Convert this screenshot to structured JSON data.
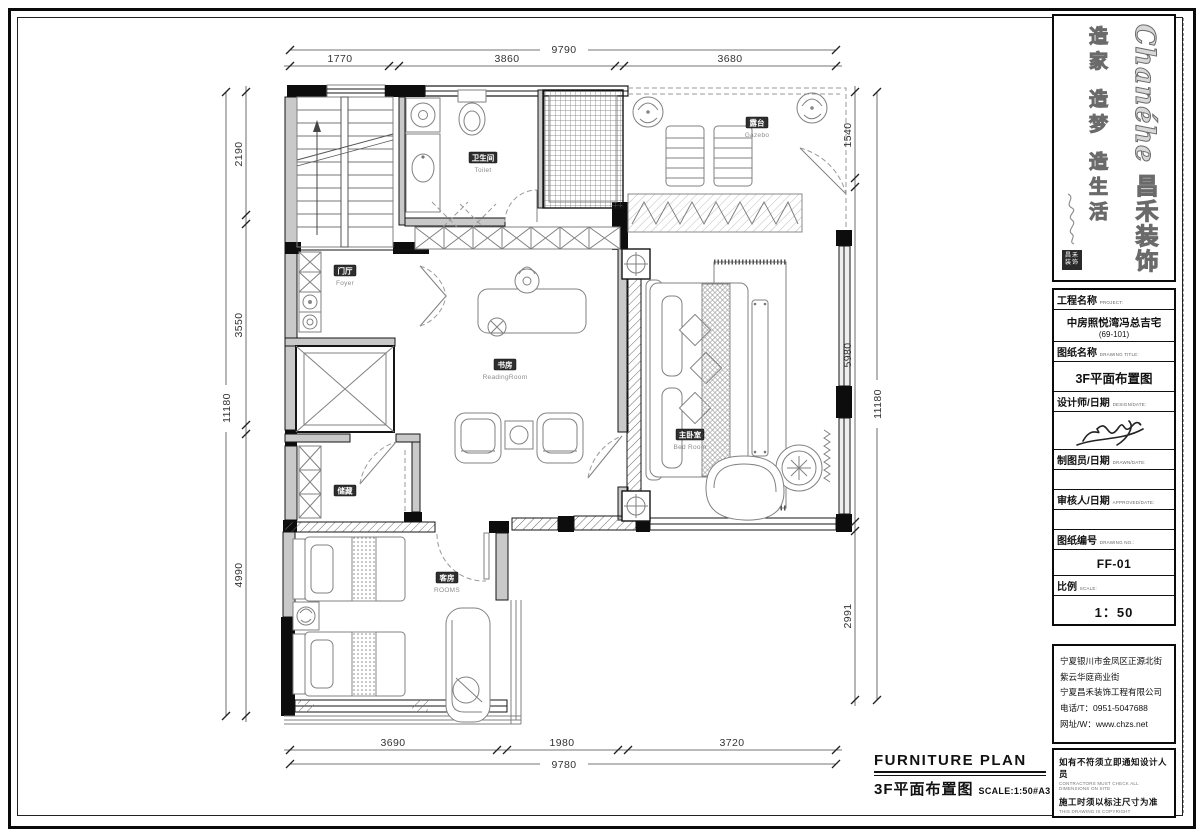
{
  "drawing": {
    "dims": {
      "top": {
        "total": "9790",
        "segments": [
          "1770",
          "3860",
          "3680"
        ]
      },
      "bottom": {
        "total": "9780",
        "segments": [
          "3690",
          "1980",
          "3720"
        ]
      },
      "left": {
        "total": "11180",
        "segments": [
          "2190",
          "3550",
          "4990"
        ]
      },
      "right": {
        "total": "11180",
        "segments": [
          "1540",
          "5980",
          "2991"
        ]
      }
    },
    "rooms": {
      "toilet": {
        "cn": "卫生间",
        "en": "Toilet"
      },
      "gazebo": {
        "cn": "露台",
        "en": "Gazebo"
      },
      "foyer": {
        "cn": "门厅",
        "en": "Foyer"
      },
      "reading": {
        "cn": "书房",
        "en": "ReadingRoom"
      },
      "bedroom": {
        "cn": "主卧室",
        "en": "Bed Room"
      },
      "storage": {
        "cn": "储藏",
        "en": ""
      },
      "guest": {
        "cn": "客房",
        "en": "ROOMS"
      }
    },
    "caption": {
      "en": "FURNITURE PLAN",
      "cn": "3F平面布置图",
      "scale": "SCALE:1:50#A3"
    }
  },
  "titleblock": {
    "brand": {
      "name": "Chanéhe",
      "cn": "昌禾装饰",
      "slogan": "造家 造梦 造生活",
      "seal": "昌禾装饰"
    },
    "fields": {
      "project": {
        "label": "工程名称",
        "en": "PROJECT:",
        "value": "中房照悦湾冯总吉宅",
        "value2": "(69-101)"
      },
      "title": {
        "label": "图纸名称",
        "en": "DRAWING TITLE:",
        "value": "3F平面布置图"
      },
      "designer": {
        "label": "设计师/日期",
        "en": "DESIGN/DATE:"
      },
      "drafter": {
        "label": "制图员/日期",
        "en": "DRAWN/DATE:"
      },
      "approver": {
        "label": "审核人/日期",
        "en": "APPROVED/DATE:"
      },
      "number": {
        "label": "图纸编号",
        "en": "DRAWING NO.:",
        "value": "FF-01"
      },
      "scale": {
        "label": "比例",
        "en": "SCALE:",
        "value": "1：50"
      }
    },
    "company": {
      "lines": [
        "宁夏银川市金凤区正源北街",
        "紫云华庭商业街",
        "宁夏昌禾装饰工程有限公司",
        "电话/T：0951-5047688",
        "网址/W：www.chzs.net"
      ]
    },
    "notes": [
      {
        "cn": "如有不符须立即通知设计人员",
        "en": "CONTRACTORS MUST CHECK ALL DIMENSIONS ON SITE"
      },
      {
        "cn": "施工时须以标注尺寸为准",
        "en": "THIS DRAWING IS COPYRIGHT"
      }
    ]
  }
}
